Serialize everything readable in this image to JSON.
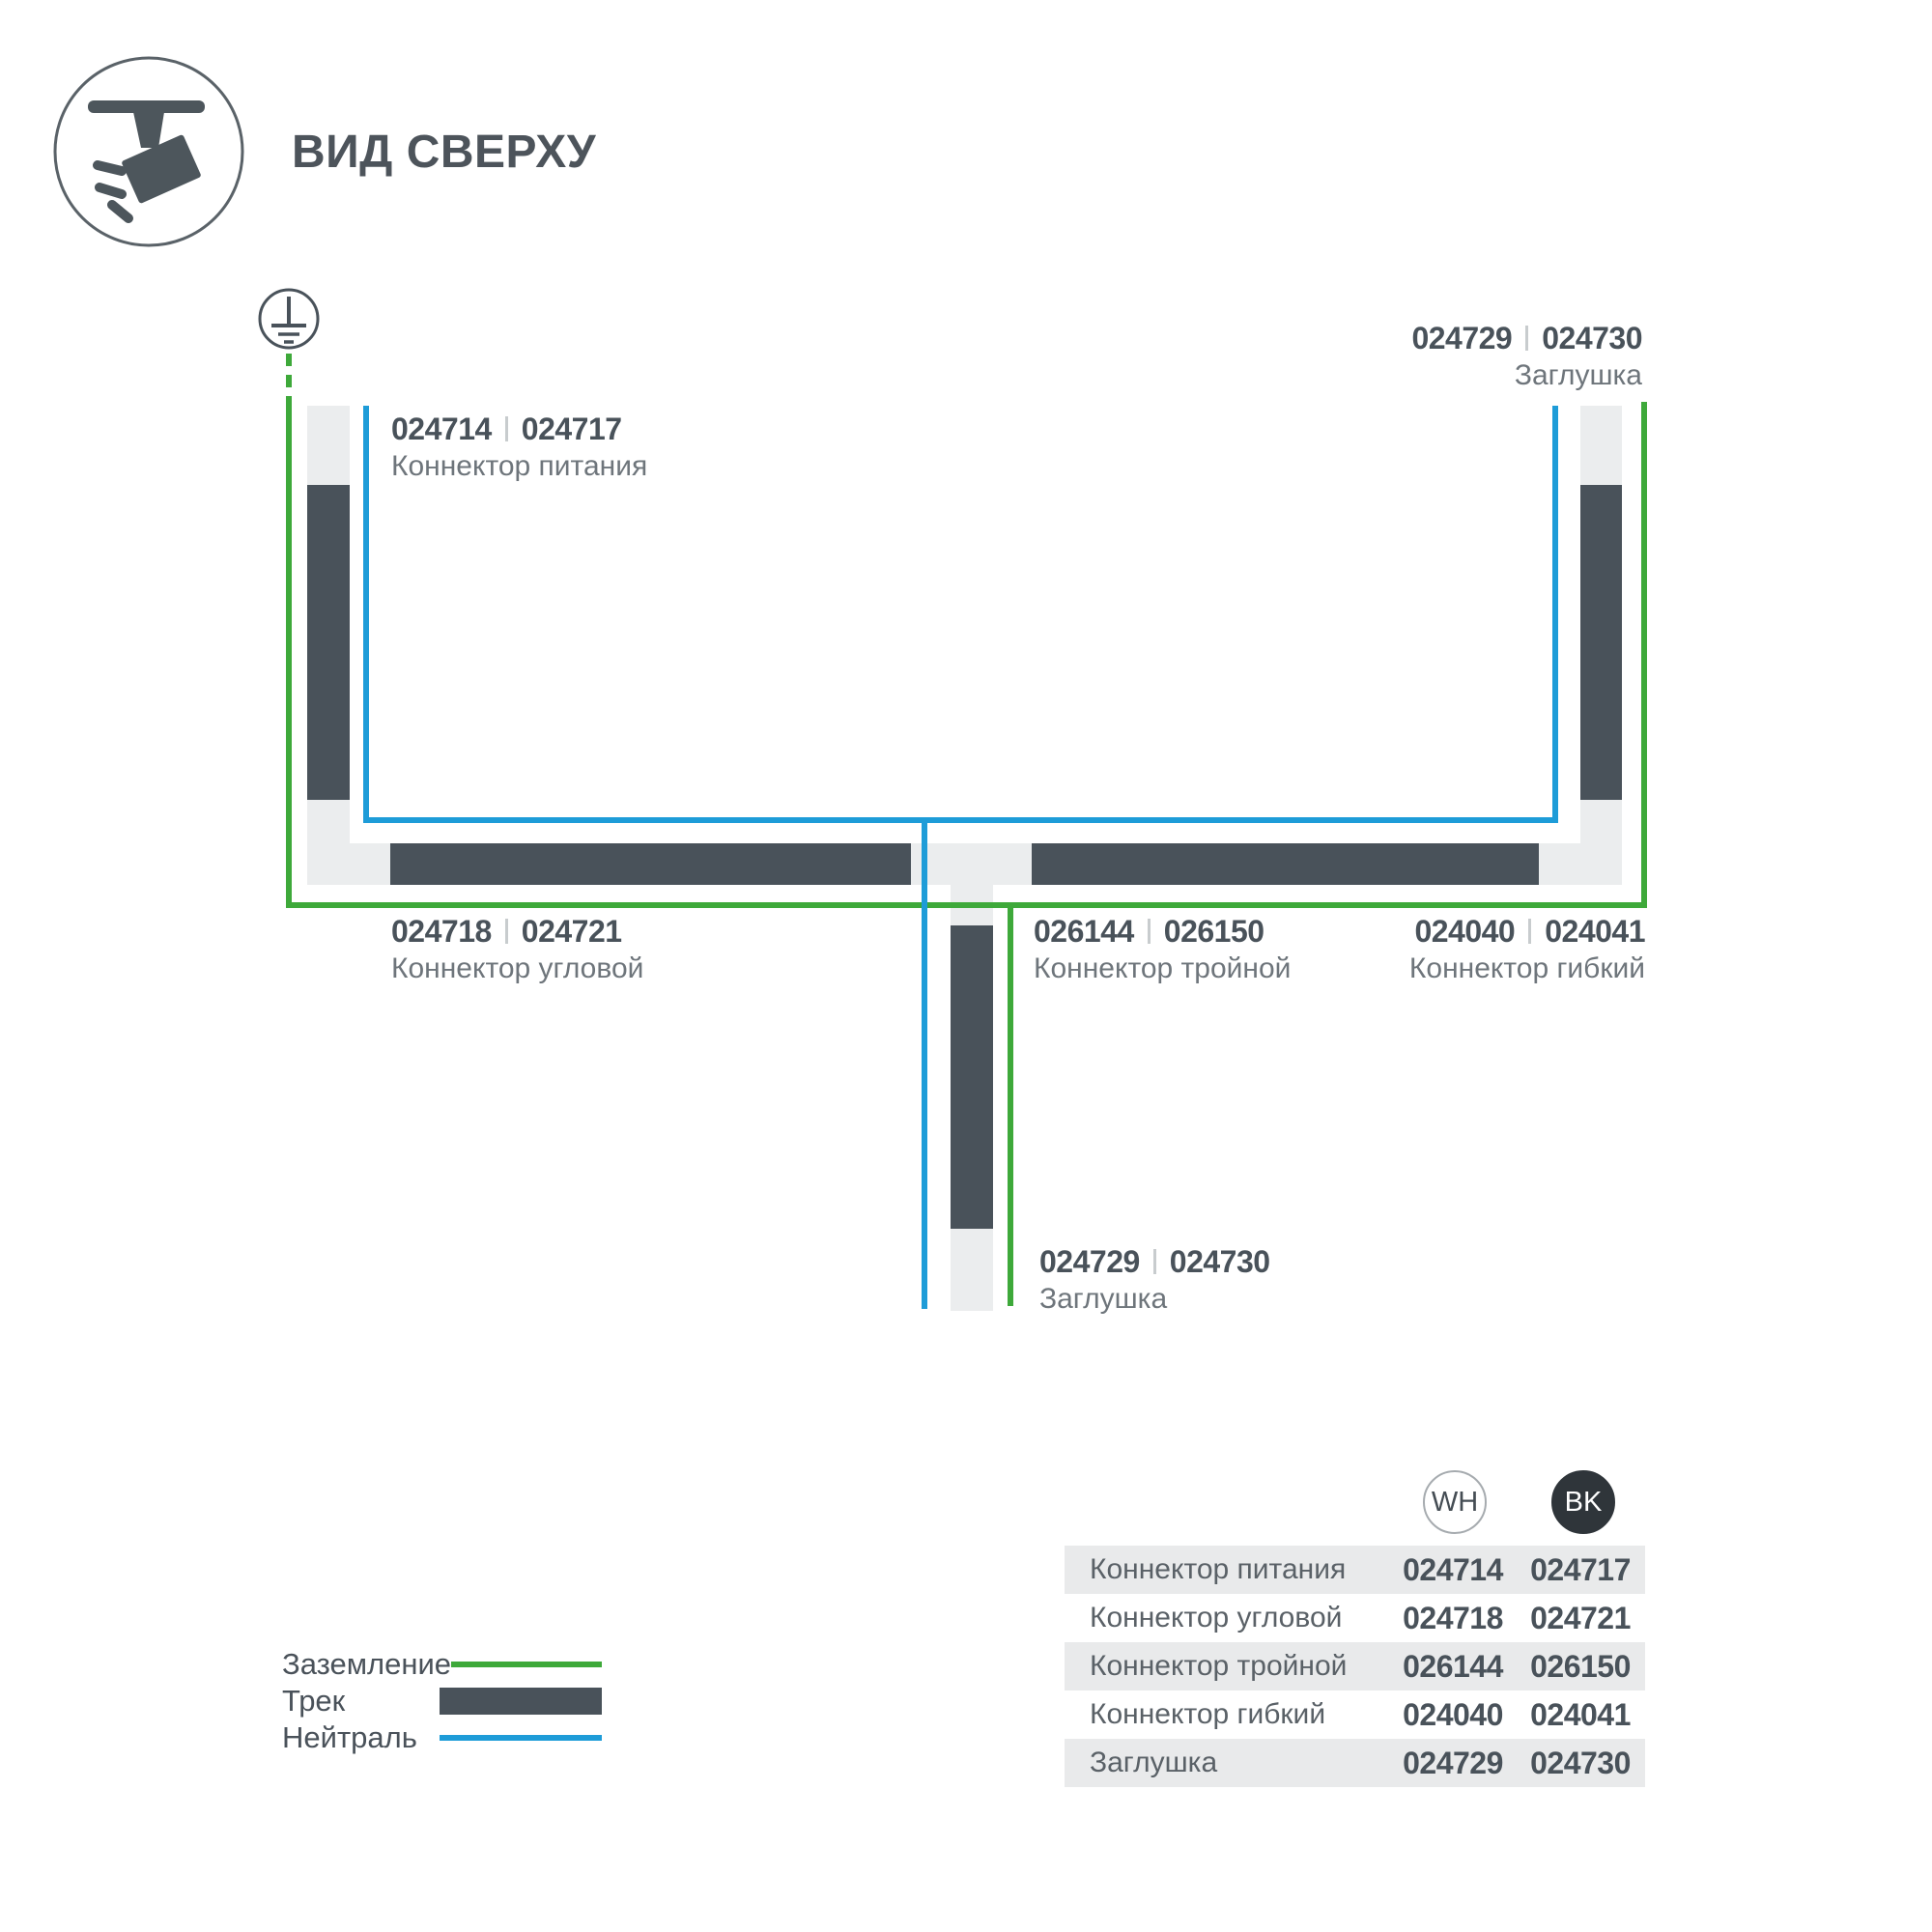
{
  "header": {
    "title": "ВИД СВЕРХУ"
  },
  "colors": {
    "track": "#49525A",
    "track_light": "#EBEDEE",
    "ground": "#3EA93A",
    "neutral": "#1E9CD8",
    "text_dark": "#49525A",
    "text_muted": "#6E757B",
    "row_gray": "#E9EAEB",
    "bk_fill": "#2F353A"
  },
  "diagram": {
    "labels": {
      "power": {
        "wh": "024714",
        "bk": "024717",
        "name": "Коннектор питания"
      },
      "endcap_top": {
        "wh": "024729",
        "bk": "024730",
        "name": "Заглушка"
      },
      "corner": {
        "wh": "024718",
        "bk": "024721",
        "name": "Коннектор угловой"
      },
      "triple": {
        "wh": "026144",
        "bk": "026150",
        "name": "Коннектор тройной"
      },
      "flex": {
        "wh": "024040",
        "bk": "024041",
        "name": "Коннектор гибкий"
      },
      "endcap_bottom": {
        "wh": "024729",
        "bk": "024730",
        "name": "Заглушка"
      }
    }
  },
  "legend": {
    "ground": "Заземление",
    "track": "Трек",
    "neutral": "Нейтраль"
  },
  "table": {
    "col_wh": "WH",
    "col_bk": "BK",
    "rows": [
      {
        "label": "Коннектор питания",
        "wh": "024714",
        "bk": "024717"
      },
      {
        "label": "Коннектор угловой",
        "wh": "024718",
        "bk": "024721"
      },
      {
        "label": "Коннектор тройной",
        "wh": "026144",
        "bk": "026150"
      },
      {
        "label": "Коннектор гибкий",
        "wh": "024040",
        "bk": "024041"
      },
      {
        "label": "Заглушка",
        "wh": "024729",
        "bk": "024730"
      }
    ]
  }
}
